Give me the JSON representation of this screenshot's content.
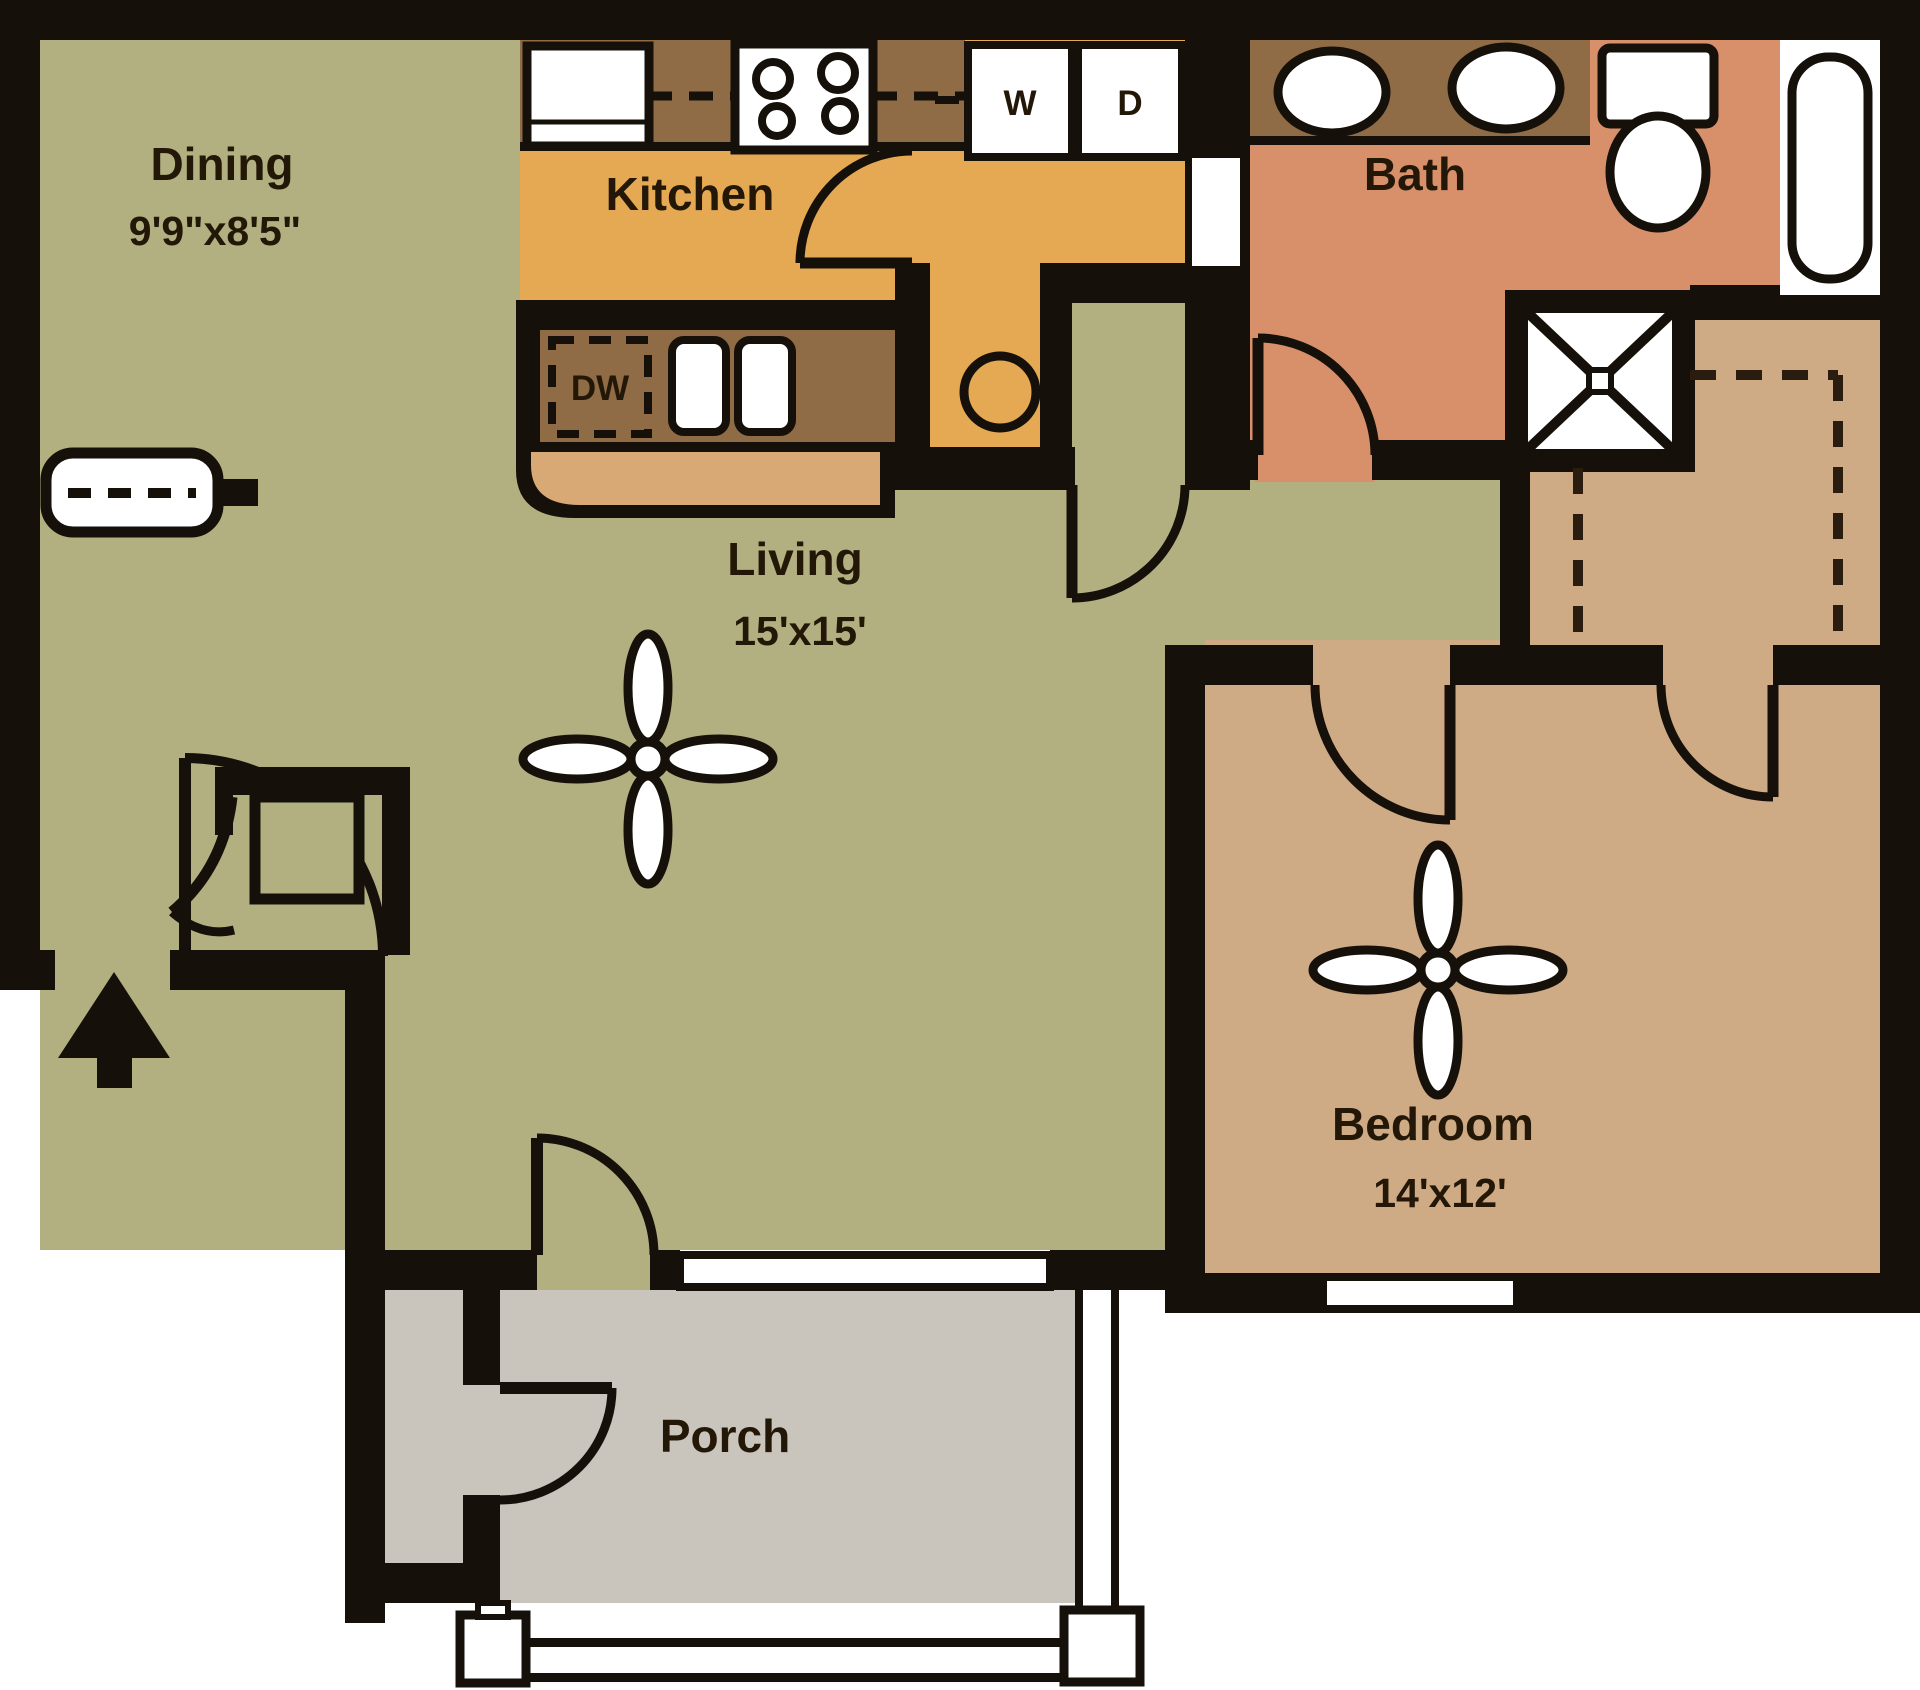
{
  "title": "One bedroom apartment floor plan",
  "rooms": {
    "dining": {
      "name": "Dining",
      "dims": "9'9\"x8'5\""
    },
    "kitchen": {
      "name": "Kitchen",
      "dims": ""
    },
    "bath": {
      "name": "Bath",
      "dims": ""
    },
    "living": {
      "name": "Living",
      "dims": "15'x15'"
    },
    "bedroom": {
      "name": "Bedroom",
      "dims": "14'x12'"
    },
    "porch": {
      "name": "Porch",
      "dims": ""
    }
  },
  "appliances": {
    "dishwasher": "DW",
    "washer": "W",
    "dryer": "D"
  },
  "fixtures": [
    "refrigerator",
    "range-4-burner",
    "double-sink",
    "dishwasher",
    "washer",
    "dryer",
    "water-heater",
    "vanity-double-sink",
    "toilet",
    "bathtub",
    "shower-stall",
    "ceiling-fan-living",
    "ceiling-fan-bedroom",
    "entry-closet-unit",
    "dining-wall-shelf",
    "porch-storage",
    "porch-railing"
  ],
  "colors": {
    "wall": "#16100a",
    "dining_living_floor": "#b2af80",
    "kitchen_floor": "#e5a853",
    "counter_brown": "#8f6b46",
    "counter_front": "#d9a975",
    "bath_floor": "#d8906b",
    "bedroom_floor": "#cfab85",
    "porch_floor": "#c9c4bc",
    "fixture_white": "#ffffff",
    "label_text": "#231708"
  }
}
